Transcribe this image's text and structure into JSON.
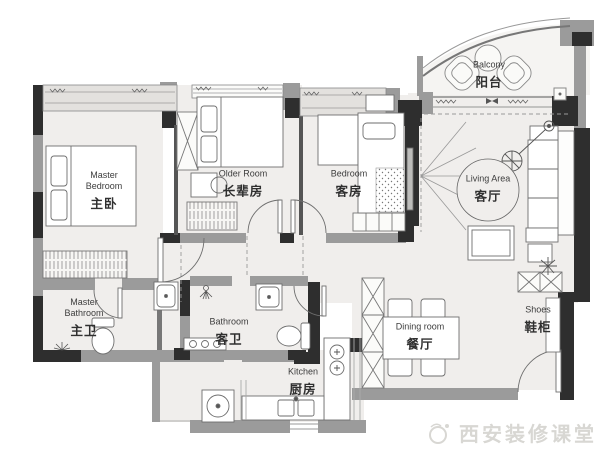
{
  "palette": {
    "wall_dark": "#2e2e2e",
    "wall_gray": "#9b9b9b",
    "floor": "#f0eeec",
    "window_band": "#e3e1de",
    "line": "#777777",
    "text": "#3a3a3a",
    "watermark": "#d8d7d3"
  },
  "rooms": {
    "master_bedroom": {
      "en": "Master Bedroom",
      "cn": "主卧"
    },
    "older_room": {
      "en": "Older Room",
      "cn": "长辈房"
    },
    "bedroom": {
      "en": "Bedroom",
      "cn": "客房"
    },
    "balcony": {
      "en": "Balcony",
      "cn": "阳台"
    },
    "living_area": {
      "en": "Living Area",
      "cn": "客厅"
    },
    "master_bathroom": {
      "en": "Master Bathroom",
      "cn": "主卫"
    },
    "bathroom": {
      "en": "Bathroom",
      "cn": "客卫"
    },
    "kitchen": {
      "en": "Kitchen",
      "cn": "厨房"
    },
    "dining_room": {
      "en": "Dining room",
      "cn": "餐厅"
    },
    "shoe_cabinet": {
      "en": "Shoes",
      "cn": "鞋柜"
    }
  },
  "watermark": {
    "text": "西安装修课堂"
  }
}
